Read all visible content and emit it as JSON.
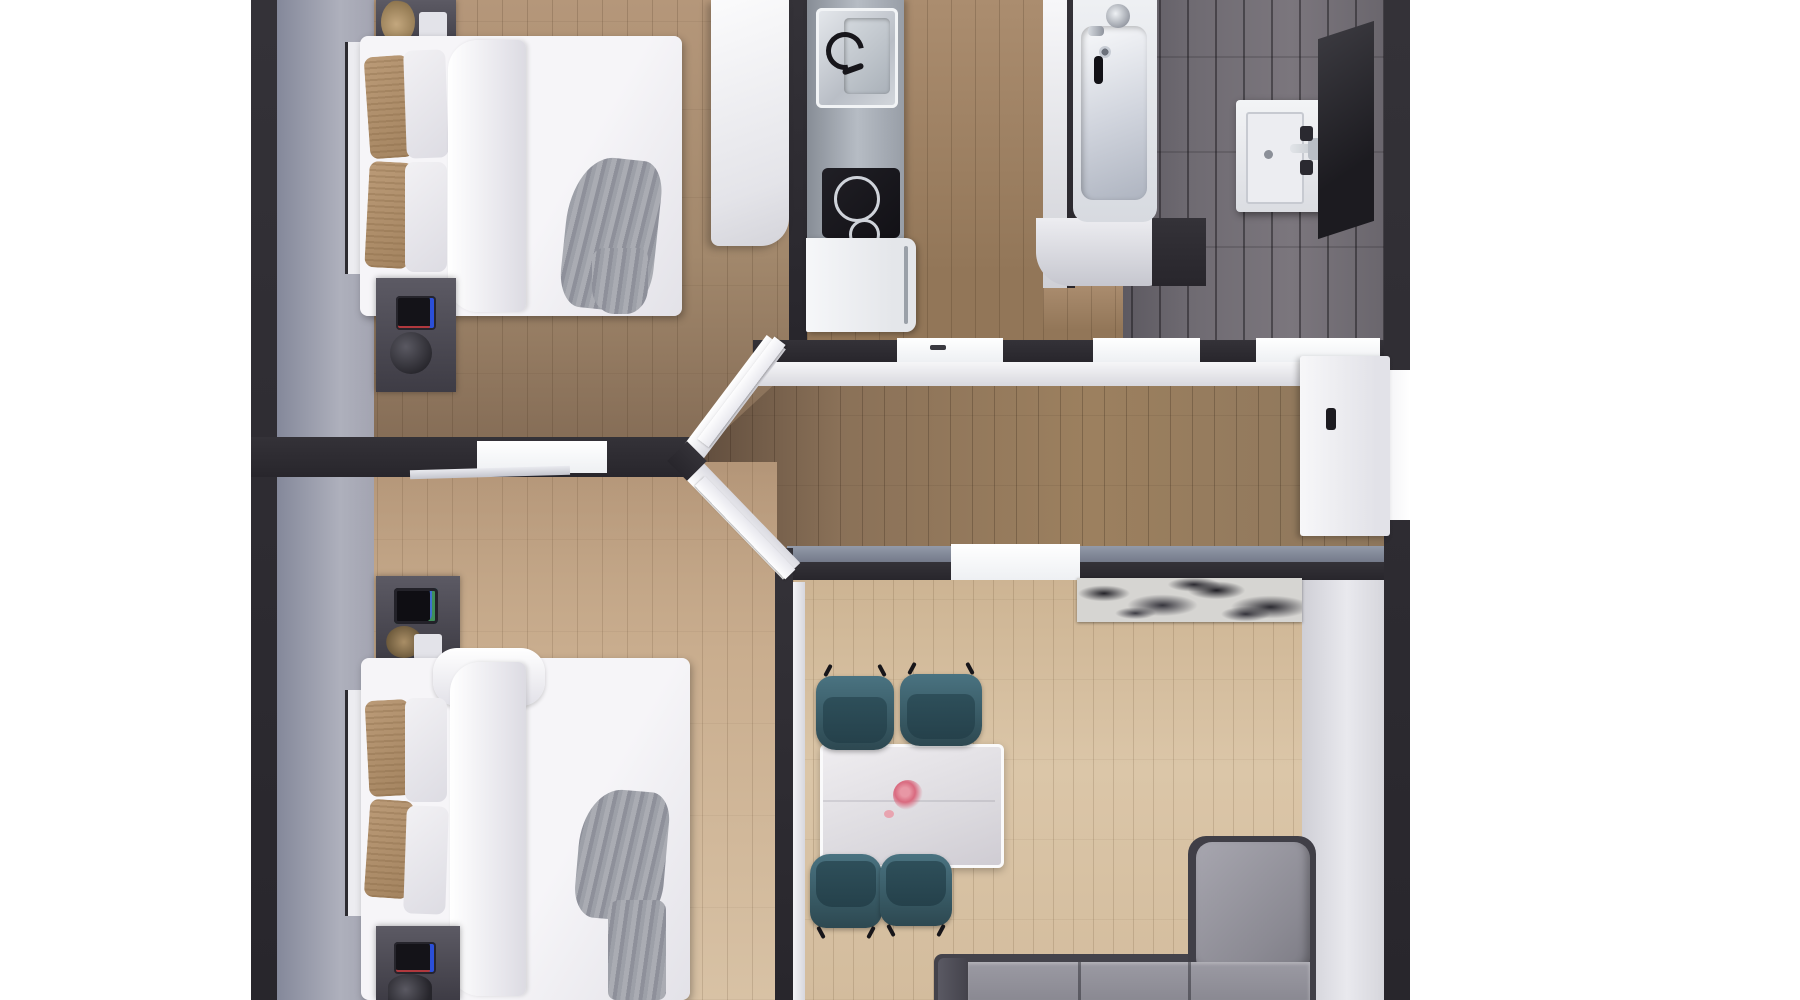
{
  "meta": {
    "title": "Apartment floor plan – photoreal top-down 3D render",
    "view": "orthographic top view, plan cropped at top and bottom edges",
    "background": "#ffffff"
  },
  "rooms": {
    "bedroom1": {
      "label": "Bedroom 1 (top left)",
      "floor": "wood planks with grey runner along left wall"
    },
    "kitchen": {
      "label": "Kitchen (top centre)",
      "floor": "wood planks"
    },
    "bathroom": {
      "label": "Bathroom (top right)",
      "floor": "dark grey tiles"
    },
    "hallway": {
      "label": "Hallway (centre corridor with chevron end)",
      "floor": "dark wood planks"
    },
    "bedroom2": {
      "label": "Bedroom 2 (bottom left)",
      "floor": "light wood planks with grey runner"
    },
    "living": {
      "label": "Living / dining room (bottom right)",
      "floor": "light wood planks"
    }
  },
  "furniture": {
    "bed1": {
      "label": "Double bed with white duvet, tan & white pillows, grey throw"
    },
    "bed2": {
      "label": "Double bed with white duvet, tan & white pillows, grey throw"
    },
    "wardrobe1": {
      "label": "White wardrobe column"
    },
    "nightstand1_top": {
      "label": "Nightstand with dried plant and white box"
    },
    "nightstand1_bottom": {
      "label": "Nightstand with phone and dark vase"
    },
    "nightstand2_top": {
      "label": "Nightstand with tablet, dried plant and white box"
    },
    "nightstand2_bottom": {
      "label": "Nightstand with phone and dark vase"
    },
    "counter": {
      "label": "Grey kitchen counter run"
    },
    "sink": {
      "label": "Kitchen sink with faucet"
    },
    "cooktop": {
      "label": "Black induction cooktop, two rings"
    },
    "fridge": {
      "label": "White appliance / fridge"
    },
    "bathtub": {
      "label": "Built-in bathtub with chrome fixtures"
    },
    "vanity": {
      "label": "White vanity basin with faucet and toiletries"
    },
    "mirror": {
      "label": "Dark slanted mirror panel"
    },
    "entrance_door": {
      "label": "White entrance door with dark handle"
    },
    "dining_table": {
      "label": "White dining table with pink flowers"
    },
    "chairs": {
      "label": "Teal dining chair",
      "count": 4
    },
    "sofa": {
      "label": "Grey L-shaped sectional sofa (bottom-right corner)"
    },
    "rug": {
      "label": "Black & white marbled runner rug"
    },
    "doors_open": {
      "label": "Two white bedroom doors open against angled hallway walls"
    }
  },
  "palette": {
    "wall_dark": "#2b292e",
    "wall_white_face": "#f4f4f6",
    "wood_dark": "#8a7158",
    "wood_light": "#d8c2a5",
    "grey_runner": "#a3a4b1",
    "tile_grey": "#6f6b72",
    "chair_teal": "#3e6470",
    "sofa_grey": "#95949d",
    "flower_pink": "#e08b9b",
    "duvet_white": "#f6f5f8"
  }
}
